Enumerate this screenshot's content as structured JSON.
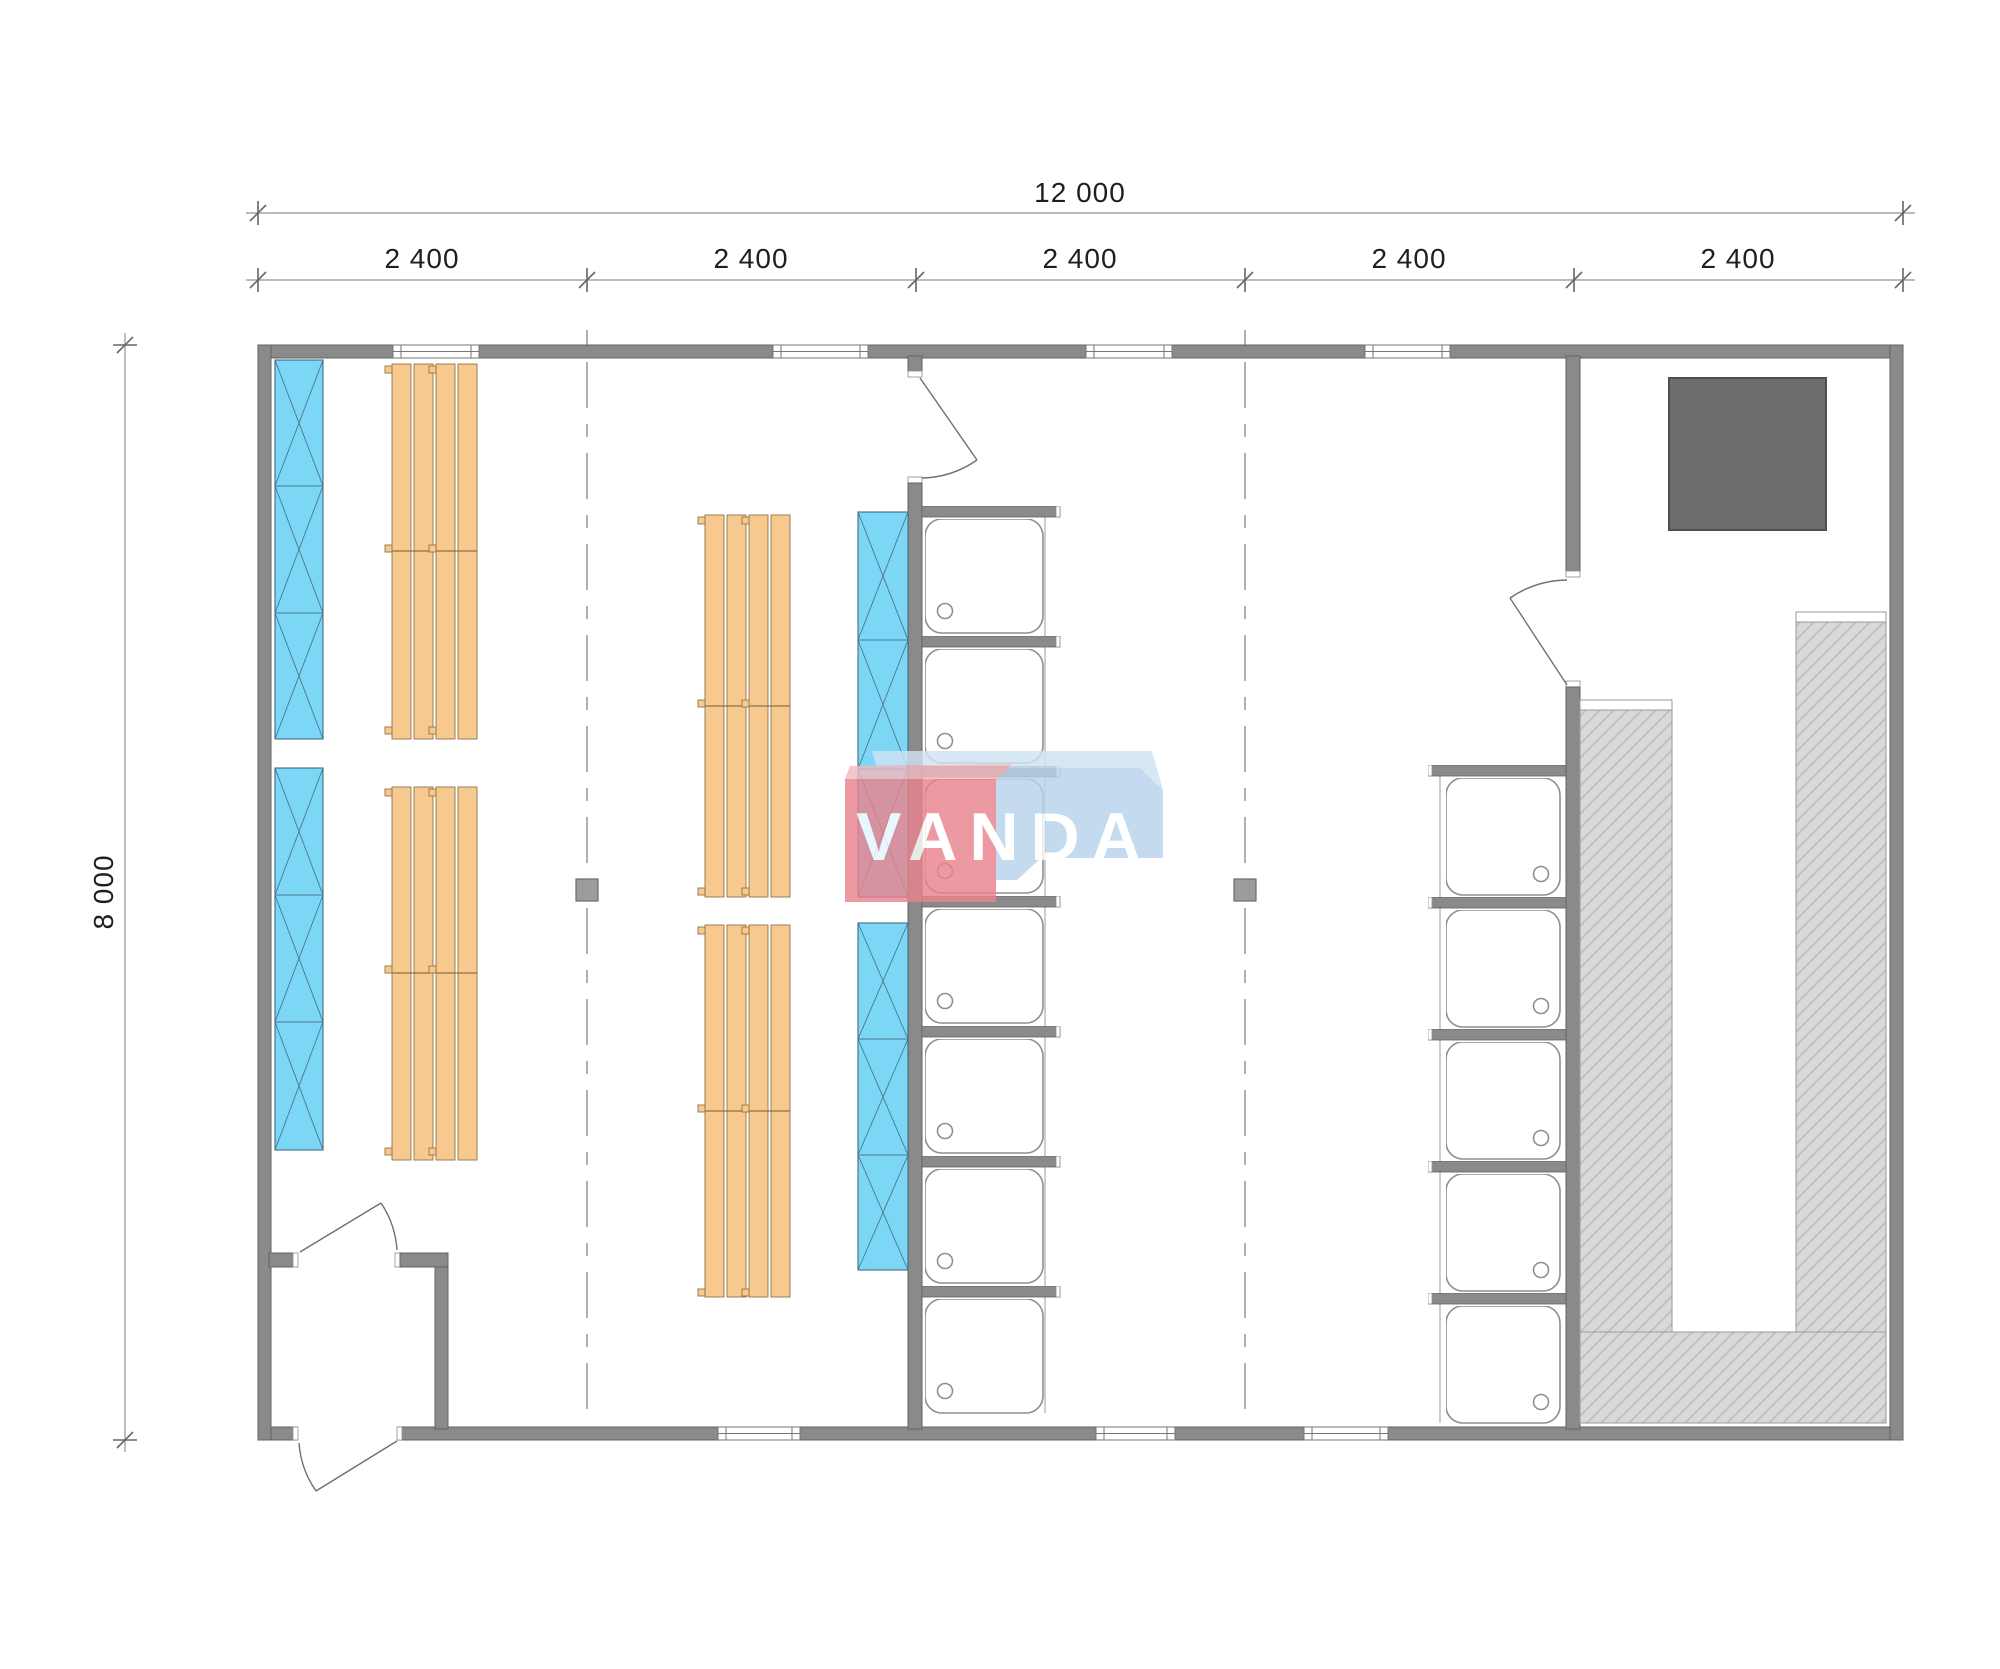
{
  "dims": {
    "overall_width": "12 000",
    "overall_height": "8 000",
    "bays": [
      "2 400",
      "2 400",
      "2 400",
      "2 400",
      "2 400"
    ]
  },
  "watermark": {
    "text": "VANDA",
    "red_shape_color": "#e9838d",
    "blue_shape_color": "#b7d3ec",
    "text_color": "#ffffff"
  },
  "palette": {
    "wall_gray": "#8a8a8a",
    "wall_outline": "#636363",
    "locker_blue": "#7cd7f7",
    "bench_wood_orange": "#f7c98e",
    "sauna_bench_hatch": "#d9d9d9",
    "stove_dark_gray": "#6d6d6d",
    "fixture_outline": "#8f8f8f",
    "dimension_text": "#1f1f1f"
  }
}
